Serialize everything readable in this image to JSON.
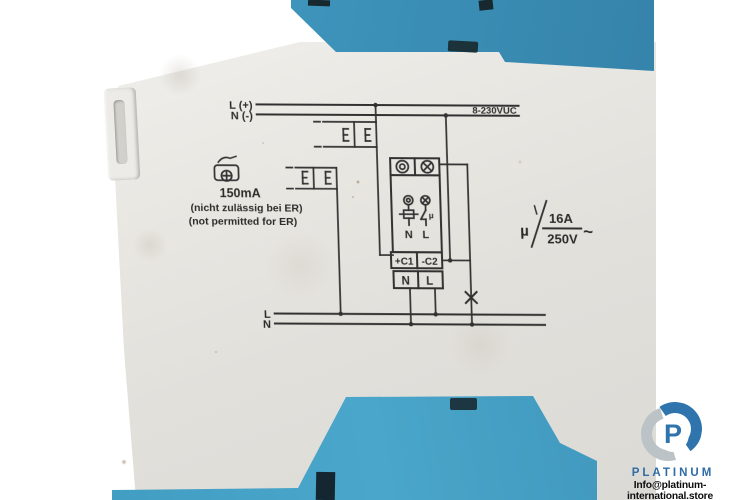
{
  "device": {
    "body_color": "#e9e7e2",
    "cover_blue": "#3c92b9",
    "base_blue": "#459fc5",
    "ink_color": "#242424"
  },
  "schematic": {
    "top_rail_l": "L (+)",
    "top_rail_n": "N (-)",
    "supply_range": "8-230VUC",
    "glow_current": "150mA",
    "note_de": "(nicht zulässig bei ER)",
    "note_en": "(not permitted for ER)",
    "inner_n": "N",
    "inner_l": "L",
    "mu": "µ",
    "ctrl_plus": "+C1",
    "ctrl_minus": "-C2",
    "term_n": "N",
    "term_l": "L",
    "bottom_rail_l": "L",
    "bottom_rail_n": "N",
    "rating_current": "16A",
    "rating_voltage": "250V",
    "rating_ac": "~"
  },
  "watermark": {
    "brand": "PLATINUM",
    "email": "Info@platinum-international.store",
    "logo_letter": "P",
    "brand_color": "#2e6ca6"
  }
}
